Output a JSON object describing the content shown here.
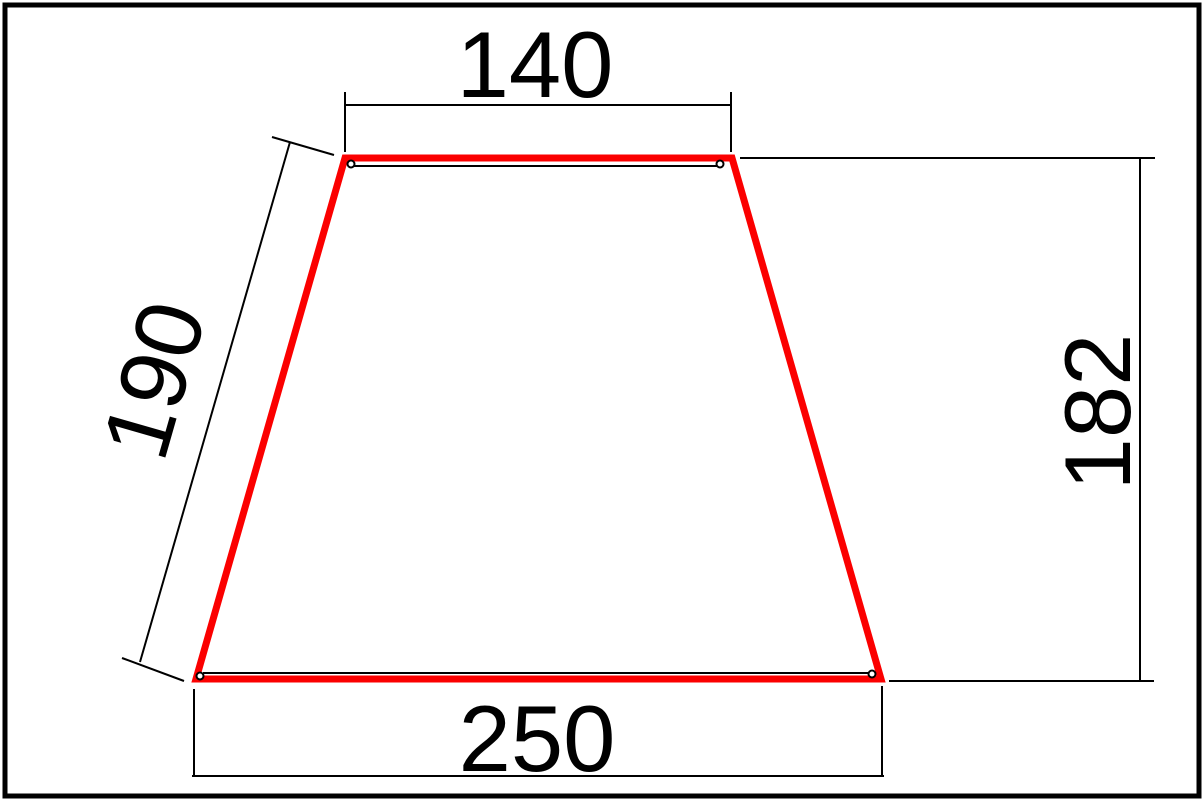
{
  "drawing": {
    "labels": {
      "top_width": "140",
      "left_side": "190",
      "right_height": "182",
      "bottom_width": "250"
    },
    "colors": {
      "outline": "#fb0000",
      "line": "#000000",
      "text": "#000000",
      "background": "#ffffff"
    }
  }
}
